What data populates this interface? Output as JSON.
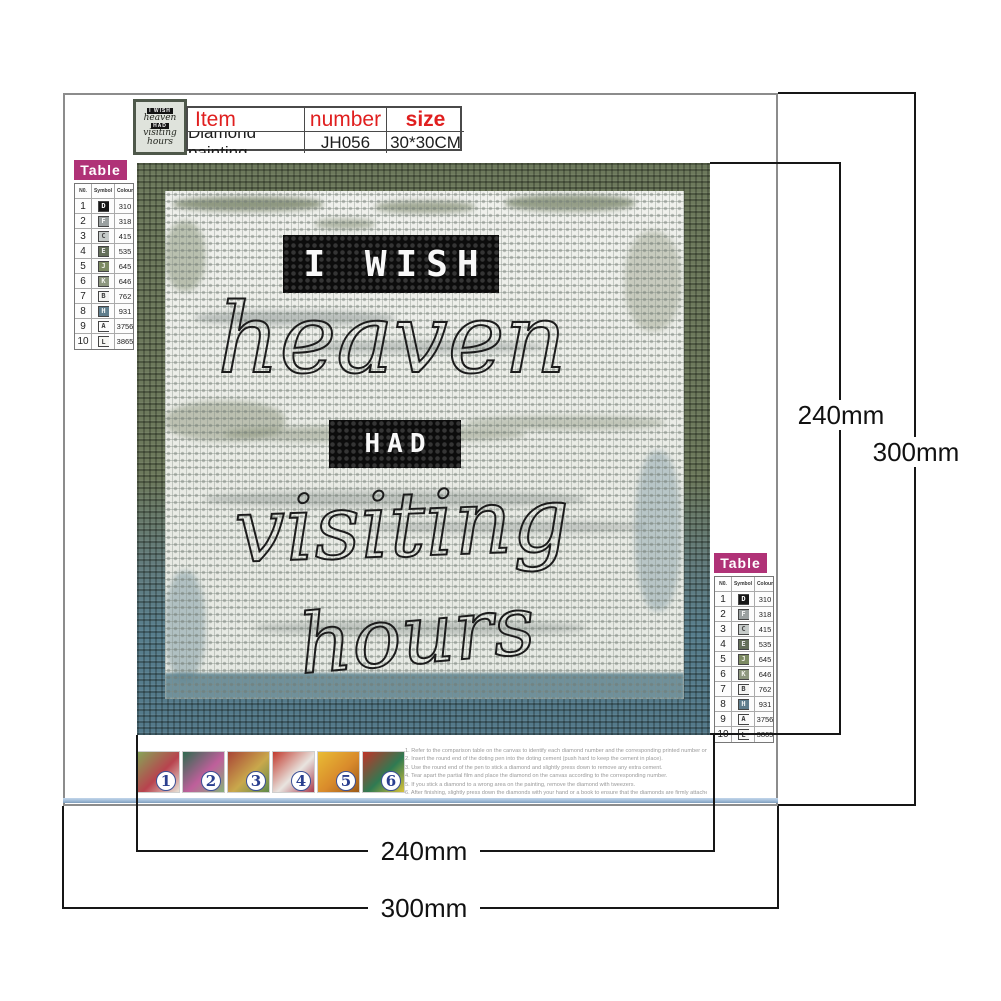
{
  "item_table": {
    "headers": [
      "Item",
      "number",
      "size"
    ],
    "row": [
      "Diamond painting",
      "JH056",
      "30*30CM"
    ]
  },
  "color_table": {
    "title": "Table",
    "headers": [
      "N0.",
      "Symbol",
      "Colour"
    ],
    "rows": [
      {
        "no": "1",
        "symbol": "D",
        "colour": "310",
        "bg": "#161616",
        "fg": "#ffffff"
      },
      {
        "no": "2",
        "symbol": "F",
        "colour": "318",
        "bg": "#9aa0a0",
        "fg": "#f5f5f5"
      },
      {
        "no": "3",
        "symbol": "C",
        "colour": "415",
        "bg": "#c6cbc9",
        "fg": "#4a4a4a"
      },
      {
        "no": "4",
        "symbol": "E",
        "colour": "535",
        "bg": "#646f5a",
        "fg": "#ececec"
      },
      {
        "no": "5",
        "symbol": "J",
        "colour": "645",
        "bg": "#7c8a62",
        "fg": "#f0f0e8"
      },
      {
        "no": "6",
        "symbol": "K",
        "colour": "646",
        "bg": "#8d977f",
        "fg": "#f2f2ec"
      },
      {
        "no": "7",
        "symbol": "B",
        "colour": "762",
        "bg": "#f4f4f2",
        "fg": "#3a3a3a"
      },
      {
        "no": "8",
        "symbol": "H",
        "colour": "931",
        "bg": "#5f7d8c",
        "fg": "#f0f4f5"
      },
      {
        "no": "9",
        "symbol": "A",
        "colour": "3756",
        "bg": "#fbfbfb",
        "fg": "#3a3a3a"
      },
      {
        "no": "10",
        "symbol": "L",
        "colour": "3865",
        "bg": "#f6f6f3",
        "fg": "#3a3a3a"
      }
    ]
  },
  "canvas_text": {
    "word1": "I WISH",
    "word2": "heaven",
    "word3": "HAD",
    "word4": "visiting",
    "word5": "hours"
  },
  "dimensions": {
    "inner_width": "240mm",
    "inner_height": "240mm",
    "outer_width": "300mm",
    "outer_height": "300mm"
  },
  "steps": [
    {
      "num": "1",
      "colors": [
        "#86a457",
        "#b8434e",
        "#e8e2d6"
      ]
    },
    {
      "num": "2",
      "colors": [
        "#2f6b4f",
        "#bf5f9b",
        "#87b07a"
      ]
    },
    {
      "num": "3",
      "colors": [
        "#a84436",
        "#c9a84c",
        "#5f8a4a"
      ]
    },
    {
      "num": "4",
      "colors": [
        "#c23b2e",
        "#e8e4df",
        "#a93c4e"
      ]
    },
    {
      "num": "5",
      "colors": [
        "#e9bc35",
        "#d98a2b",
        "#9c5a18"
      ]
    },
    {
      "num": "6",
      "colors": [
        "#c03327",
        "#2f7a52",
        "#d8c23a"
      ]
    }
  ],
  "instructions": [
    "1. Refer to the comparison table on the canvas to identify each diamond number and the corresponding printed number on the canvas.",
    "2. Insert the round end of the doting pen into the doting cement (push hard to keep the cement in place).",
    "3. Use the round end of the pen to stick a diamond and slightly press down to remove any extra cement.",
    "4. Tear apart the partial film and place the diamond on the canvas according to the corresponding number.",
    "5. If you stick a diamond to a wrong area on the painting, remove the diamond with tweezers.",
    "6. After finishing, slightly press down the diamonds with your hand or a book to ensure that the diamonds are firmly attached."
  ],
  "colors": {
    "accent_red": "#e01f1f",
    "table_magenta": "#b03277",
    "step_number_blue": "#2a3f8f",
    "canvas_olive": "#6d795c",
    "canvas_teal": "#587e8d"
  }
}
